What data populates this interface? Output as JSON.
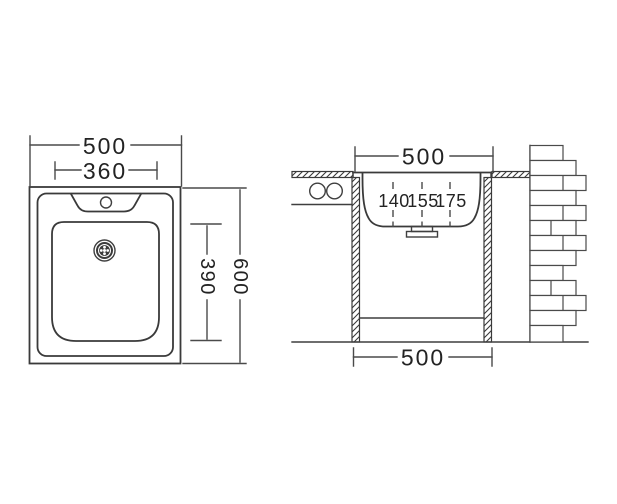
{
  "top_view": {
    "overall_width_mm": "500",
    "bowl_width_mm": "360",
    "overall_depth_mm": "600",
    "bowl_depth_mm": "390"
  },
  "section_view": {
    "rim_width_mm": "500",
    "depth_options": [
      "140",
      "155",
      "175"
    ],
    "base_width_mm": "500"
  },
  "colors": {
    "line": "#3a3a3a",
    "dimension_line": "#4a4a4a",
    "text": "#232323",
    "background": "#ffffff"
  }
}
